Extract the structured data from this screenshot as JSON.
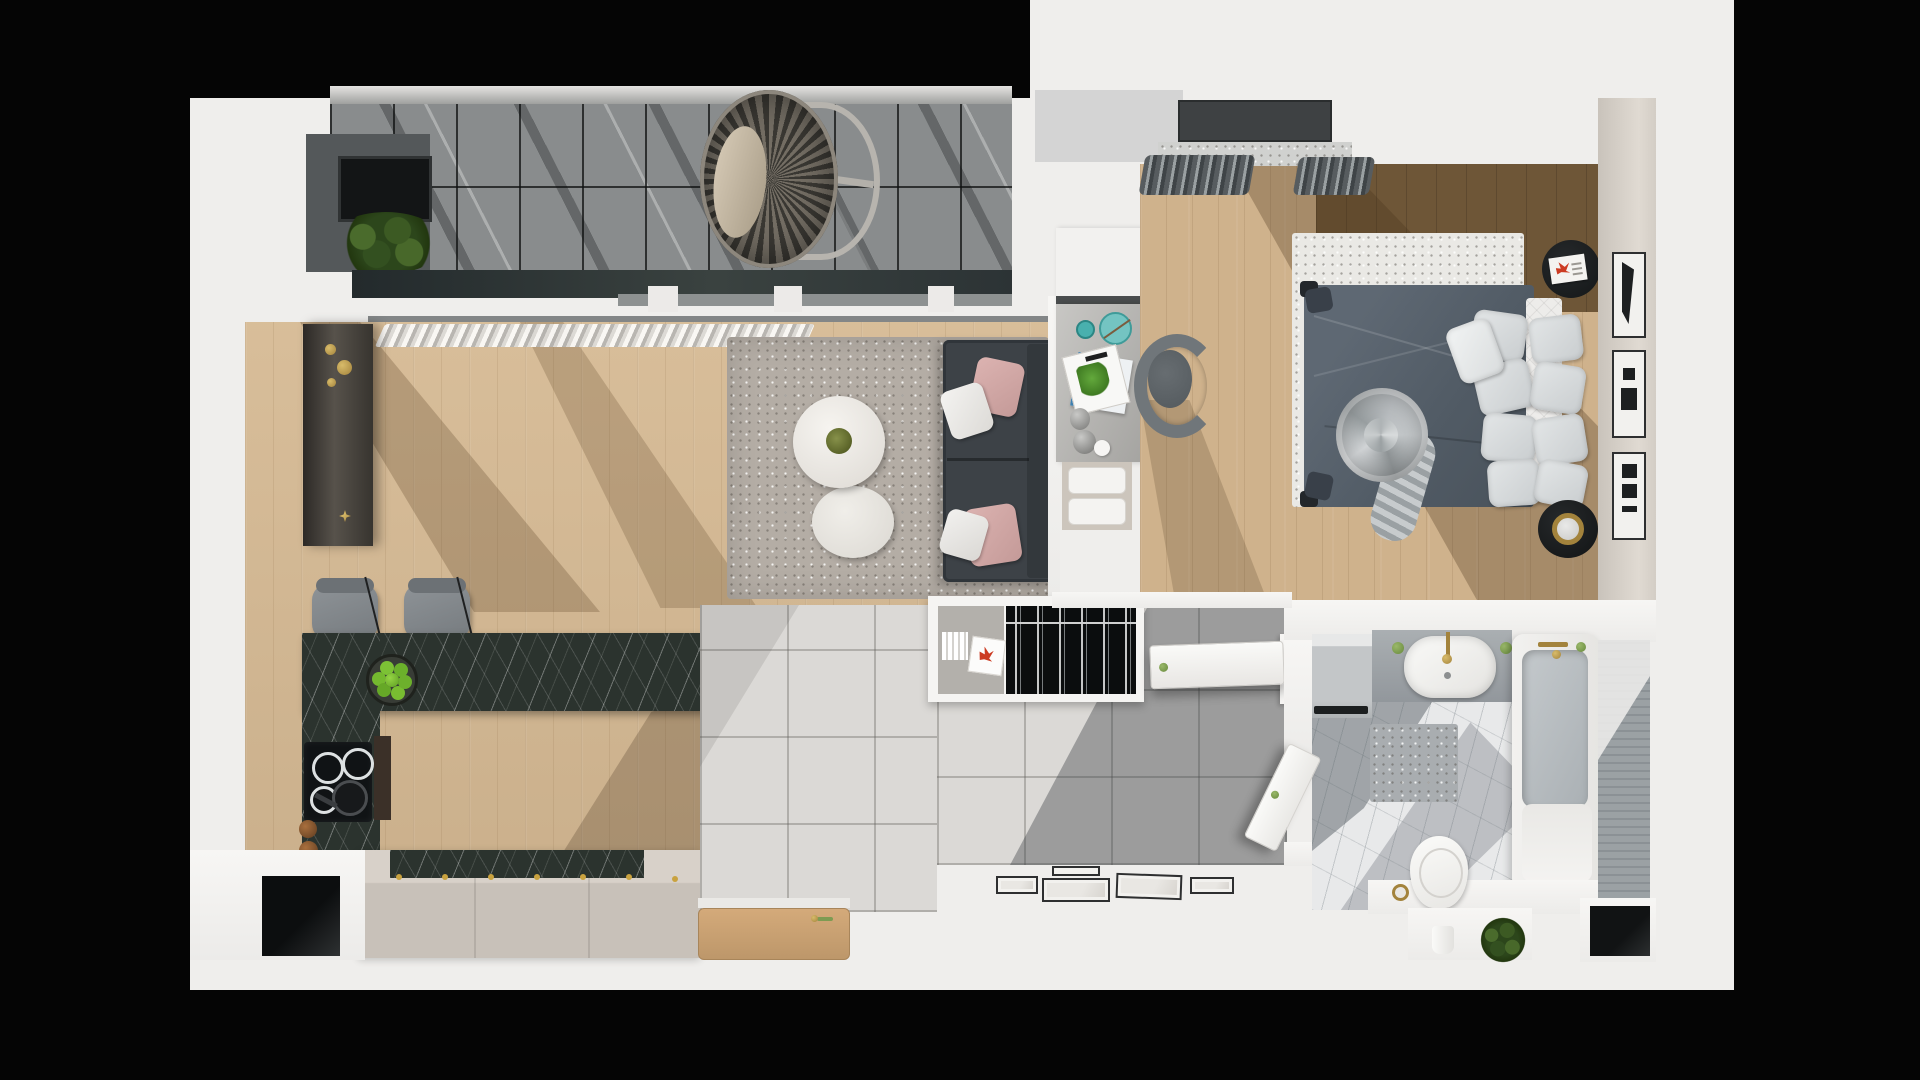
{
  "scene": {
    "type": "3d-floor-plan-top-view",
    "subject": "one-bedroom apartment architectural render",
    "visible_text": "none",
    "background_color": "#050505",
    "plan_background_color": "#efeeec"
  },
  "palette": {
    "balcony_tile": "#898c8d",
    "balcony_band": "#2c3335",
    "wood_floor": "#d6ba94",
    "wood_floor_bedroom": "#cfb28c",
    "walnut_floor": "#6e5637",
    "rug_living": "#b4ada5",
    "rug_bedroom": "#eae9e5",
    "sofa": "#3d4247",
    "pillow_pink": "#d3a8a6",
    "kitchen_marble": "#2b332e",
    "island_beige": "#cbc4bc",
    "hall_tile": "#dbd9d6",
    "bed_duvet": "#57616b",
    "bed_pillow": "#d7dadb",
    "accent_teal": "#49b0ae",
    "accent_gold": "#a3833c",
    "accent_green_apples": "#72b82e",
    "bathroom_marble": "#e8e9ea",
    "bathroom_shadow": "#59646c",
    "wall_white": "#f4f3f1",
    "right_wall_beige": "#d3cdc5",
    "door_wood": "#caa172"
  },
  "rooms": [
    {
      "id": "balcony",
      "label": "balcony with glass roof",
      "furniture": [
        "hanging-egg-chair",
        "potted-plant",
        "ac-unit",
        "tiled-floor-grid"
      ]
    },
    {
      "id": "living-room",
      "label": "living room",
      "furniture": [
        "corner-sofa",
        "pink-pillows",
        "round-coffee-tables",
        "shag-rug",
        "sideboard",
        "curtains"
      ]
    },
    {
      "id": "kitchen",
      "label": "kitchen",
      "furniture": [
        "l-shaped-marble-counter",
        "induction-cooktop",
        "bar-stools",
        "apple-bowl",
        "island-cabinet",
        "copper-pots"
      ]
    },
    {
      "id": "hallway",
      "label": "entrance hallway",
      "furniture": [
        "open-wardrobe-with-hangers",
        "book-cubby",
        "picture-frames",
        "wooden-entrance-door",
        "tiled-floor"
      ]
    },
    {
      "id": "bedroom",
      "label": "bedroom",
      "furniture": [
        "double-bed",
        "pillow-stack",
        "rolled-blanket",
        "desk-with-accessories",
        "office-chair",
        "round-nightstands",
        "wall-art-panels",
        "window-with-curtains"
      ]
    },
    {
      "id": "bathroom",
      "label": "bathroom",
      "furniture": [
        "bathtub",
        "vanity-sink",
        "toilet",
        "washing-machine",
        "bath-mat",
        "plant",
        "gold-faucets"
      ]
    }
  ],
  "labels": {
    "balcony": "balcony",
    "living_room": "living room",
    "kitchen": "kitchen",
    "hallway": "hallway",
    "bedroom": "bedroom",
    "bathroom": "bathroom"
  }
}
